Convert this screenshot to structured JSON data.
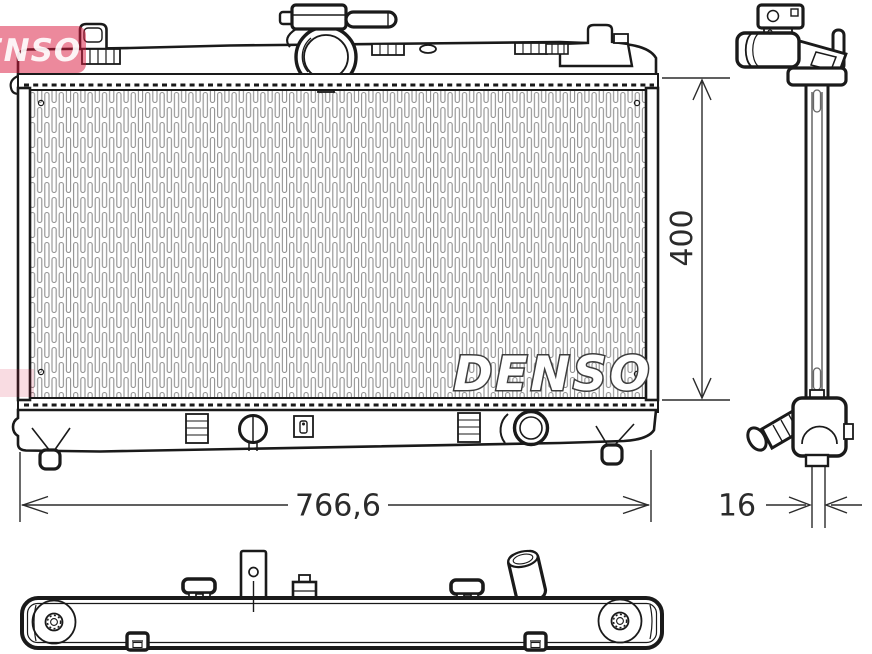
{
  "drawing": {
    "brand_logo_text": "DENSO",
    "watermark_text": "DENSO"
  },
  "dimensions": {
    "height_mm": "400",
    "width_mm": "766,6",
    "depth_mm": "16"
  },
  "colors": {
    "line": "#1a1a1a",
    "brand_red": "#d9143a",
    "hatch_gray": "#909090",
    "background": "#ffffff"
  }
}
